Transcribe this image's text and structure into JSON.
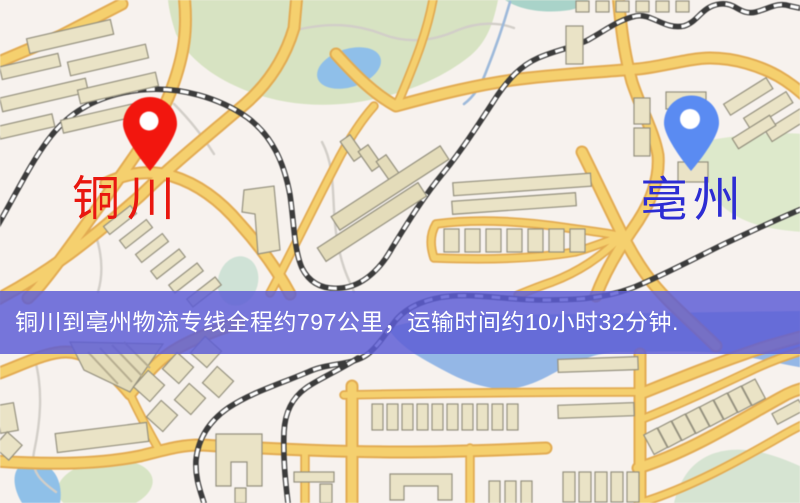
{
  "map": {
    "banner": {
      "text": "铜川到亳州物流专线全程约797公里，运输时间约10小时32分钟.",
      "bg_color": "#5d5dd5",
      "text_color": "#ffffff"
    },
    "origin": {
      "label": "铜川",
      "pin_color": "#f2160e",
      "label_color": "#e9170f"
    },
    "destination": {
      "label": "亳州",
      "pin_color": "#5a8bf2",
      "label_color": "#2d2dd3"
    },
    "palette": {
      "background": "#f7f2ee",
      "road_fill": "#f5d06e",
      "road_casing": "#e2ab52",
      "park_green": "#d7e3c2",
      "water_blue": "#94b7e6",
      "building_tan": "#eae3c6",
      "railway_dark": "#3b3b3b"
    }
  }
}
